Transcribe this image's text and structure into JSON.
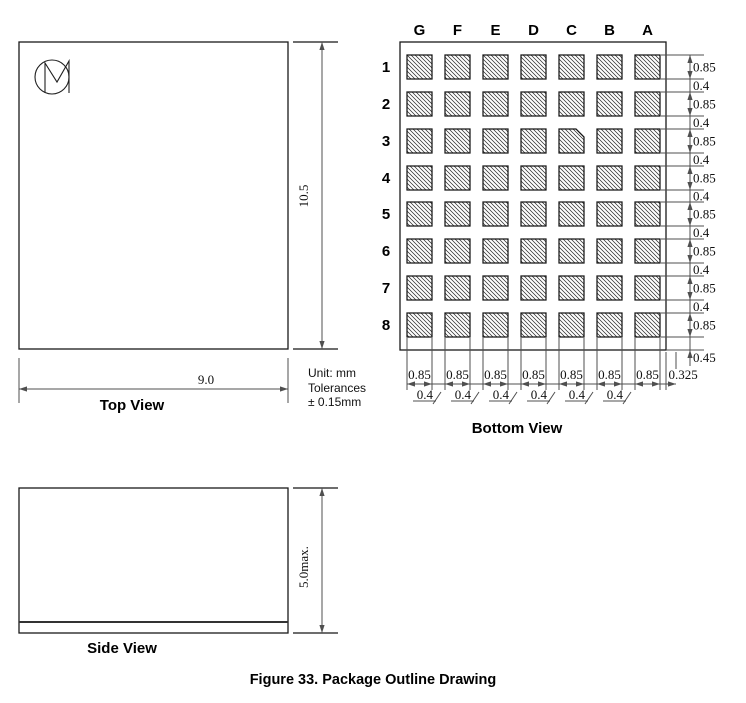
{
  "figure_caption": "Figure 33. Package Outline Drawing",
  "units_note": {
    "line1": "Unit: mm",
    "line2": "Tolerances",
    "line3": "± 0.15mm"
  },
  "colors": {
    "outline": "#1a1a1a",
    "dim": "#4f4f4f",
    "background": "#ffffff",
    "hatch": "#2e2e2e"
  },
  "icons": {
    "logo": "cm-monogram-icon"
  },
  "top_view": {
    "label": "Top View",
    "width_dim": "9.0",
    "height_dim": "10.5"
  },
  "bottom_view": {
    "label": "Bottom View",
    "column_labels": [
      "G",
      "F",
      "E",
      "D",
      "C",
      "B",
      "A"
    ],
    "row_labels": [
      "1",
      "2",
      "3",
      "4",
      "5",
      "6",
      "7",
      "8"
    ],
    "grid": {
      "columns": 7,
      "rows": 8,
      "chamfered_pad": "C3",
      "pad_fill": "diagonal-hatch"
    },
    "right_dim_chain": [
      "0.85",
      "0.4",
      "0.85",
      "0.4",
      "0.85",
      "0.4",
      "0.85",
      "0.4",
      "0.85",
      "0.4",
      "0.85",
      "0.4",
      "0.85",
      "0.4",
      "0.85"
    ],
    "bottom_edge_dim": "0.45",
    "pad_width_dims": [
      "0.85",
      "0.85",
      "0.85",
      "0.85",
      "0.85",
      "0.85",
      "0.85"
    ],
    "right_margin_dim": "0.325",
    "pad_gap_dims": [
      "0.4",
      "0.4",
      "0.4",
      "0.4",
      "0.4",
      "0.4"
    ]
  },
  "side_view": {
    "label": "Side View",
    "height_dim": "5.0max."
  }
}
